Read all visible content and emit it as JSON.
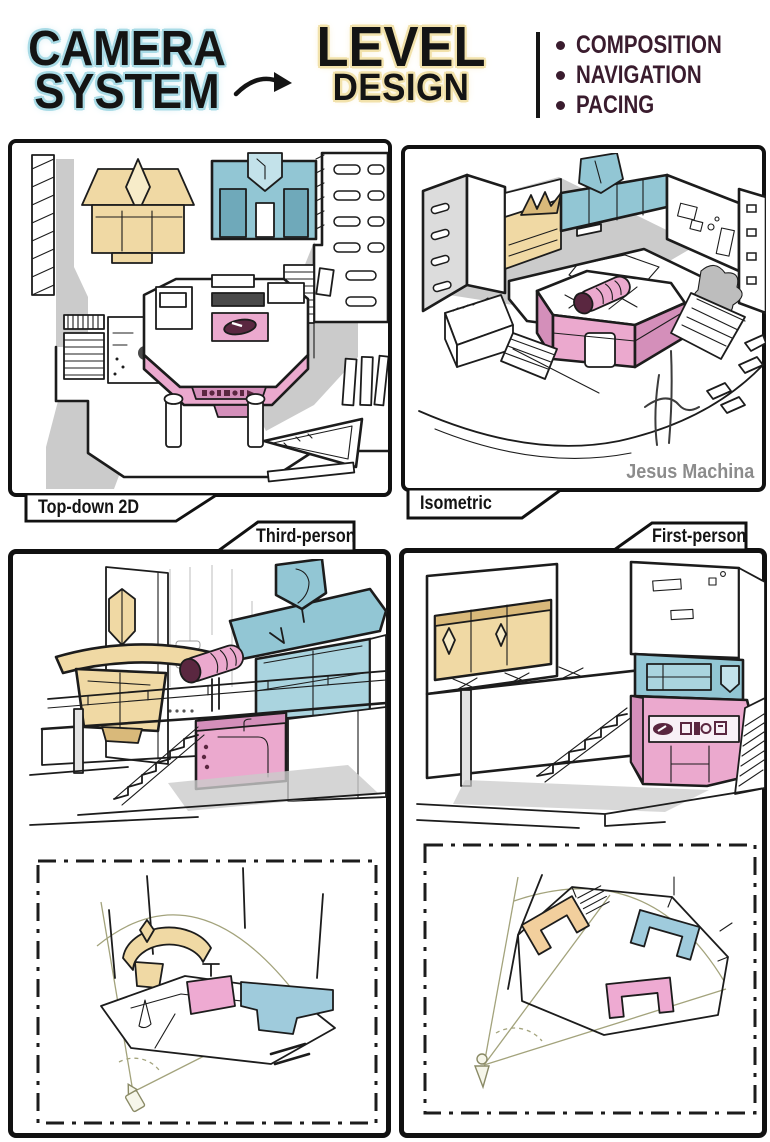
{
  "header": {
    "camera_line1": "CAMERA",
    "camera_line2": "SYSTEM",
    "level_line1": "LEVEL",
    "level_line2": "DESIGN",
    "bullets": [
      "COMPOSITION",
      "NAVIGATION",
      "PACING"
    ]
  },
  "panels": {
    "top_down": {
      "label": "Top-down 2D"
    },
    "isometric": {
      "label": "Isometric",
      "signature": "Jesus Machina"
    },
    "third_person": {
      "label": "Third-person"
    },
    "first_person": {
      "label": "First-person"
    }
  },
  "colors": {
    "ink": "#1c1c1c",
    "camera_glow_teal": "#a9dbe6",
    "level_glow_cream": "#f2e2ab",
    "bullet_text": "#3a1c2e",
    "building_teal": "#92c6d4",
    "building_teal_dark": "#6fa9ba",
    "kiosk_pink": "#eba9ce",
    "kiosk_pink_dark": "#d48fba",
    "awning_tan": "#f0d9a4",
    "shadow_gray": "#cbcbcb",
    "signature_gray": "#8c8c8c",
    "view_cone_olive": "#a3a37c"
  }
}
